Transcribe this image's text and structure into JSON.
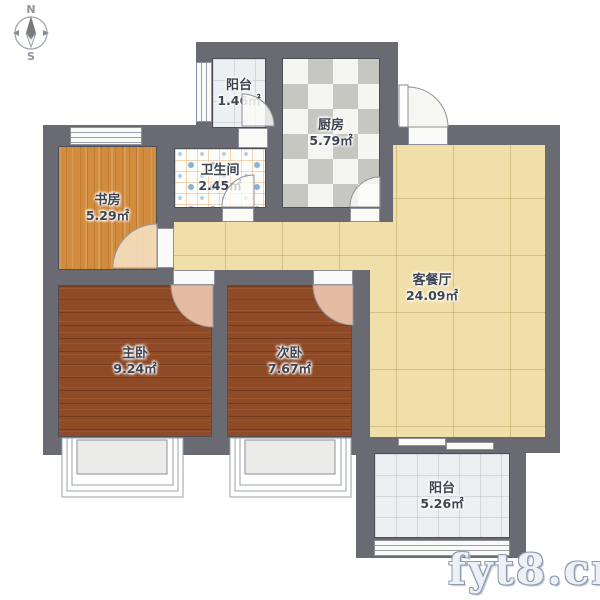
{
  "compass": {
    "north_label": "N",
    "south_label": "S"
  },
  "watermark": "fyt8.cn",
  "rooms": [
    {
      "id": "balcony-top",
      "name": "阳台",
      "area": "1.46㎡"
    },
    {
      "id": "kitchen",
      "name": "厨房",
      "area": "5.79㎡"
    },
    {
      "id": "bathroom",
      "name": "卫生间",
      "area": "2.45㎡"
    },
    {
      "id": "study",
      "name": "书房",
      "area": "5.29㎡"
    },
    {
      "id": "living-dining",
      "name": "客餐厅",
      "area": "24.09㎡"
    },
    {
      "id": "master-bedroom",
      "name": "主卧",
      "area": "9.24㎡"
    },
    {
      "id": "second-bedroom",
      "name": "次卧",
      "area": "7.67㎡"
    },
    {
      "id": "balcony-bottom",
      "name": "阳台",
      "area": "5.26㎡"
    }
  ],
  "colors": {
    "wall": "#6A6A72",
    "study_floor": "#D28C3E",
    "bedroom_floor": "#8F4B27",
    "living_floor": "#F0DFA9",
    "kitchen_checker_dark": "#C7C7C2",
    "kitchen_checker_light": "#F5F5F2",
    "bathroom_dot": "#85B4D6",
    "balcony_floor": "#EDF0F2",
    "door_swing_pink": "#E3BCA2",
    "label_text": "#3E4450",
    "watermark_outline": "#8F9CB3"
  }
}
